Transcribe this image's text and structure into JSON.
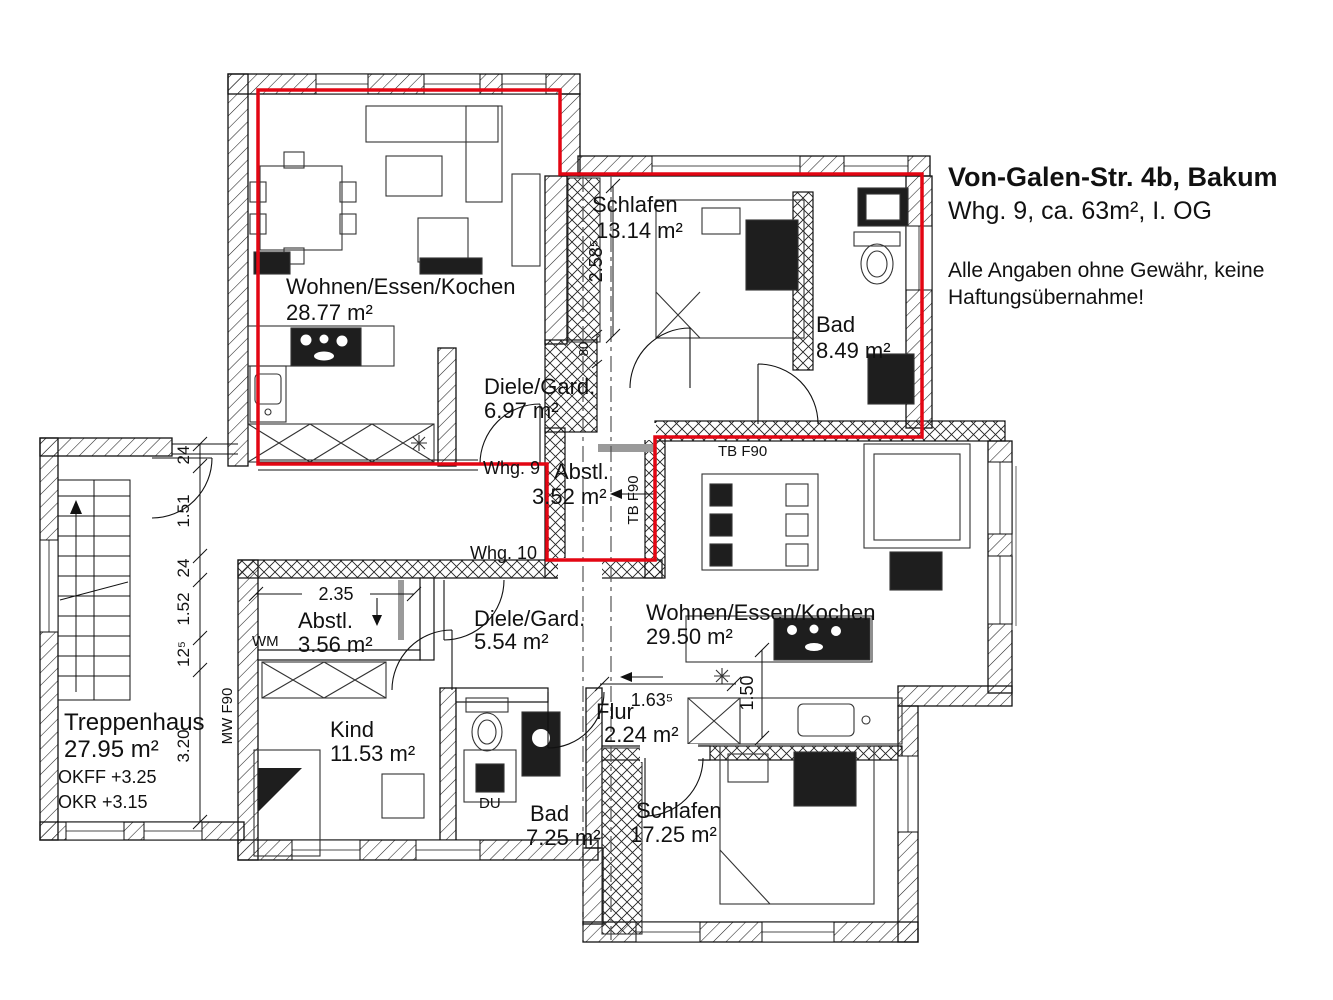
{
  "title": {
    "address": "Von-Galen-Str. 4b, Bakum",
    "unit_info": "Whg. 9, ca. 63m², I. OG",
    "disclaimer_line1": "Alle Angaben ohne Gewähr, keine",
    "disclaimer_line2": "Haftungsübernahme!"
  },
  "unit_labels": {
    "whg9": "Whg. 9",
    "whg10": "Whg. 10"
  },
  "rooms": {
    "living9": {
      "name": "Wohnen/Essen/Kochen",
      "area": "28.77 m²"
    },
    "schlafen9": {
      "name": "Schlafen",
      "area": "13.14 m²"
    },
    "bad9": {
      "name": "Bad",
      "area": "8.49 m²"
    },
    "diele9": {
      "name": "Diele/Gard.",
      "area": "6.97 m²"
    },
    "abstell9": {
      "name": "Abstl.",
      "area": "3.52 m²"
    },
    "treppenhaus": {
      "name": "Treppenhaus",
      "area": "27.95 m²",
      "okff": "OKFF +3.25",
      "okr": "OKR +3.15"
    },
    "abstell10": {
      "name": "Abstl.",
      "area": "3.56 m²"
    },
    "diele10": {
      "name": "Diele/Gard.",
      "area": "5.54 m²"
    },
    "living10": {
      "name": "Wohnen/Essen/Kochen",
      "area": "29.50 m²"
    },
    "kind": {
      "name": "Kind",
      "area": "11.53 m²"
    },
    "flur": {
      "name": "Flur",
      "area": "2.24 m²"
    },
    "bad10": {
      "name": "Bad",
      "area": "7.25 m²"
    },
    "schlafen10": {
      "name": "Schlafen",
      "area": "17.25 m²"
    }
  },
  "dimensions": {
    "chain": [
      "24",
      "1.51",
      "24",
      "1.52",
      "12⁵",
      "3.20"
    ],
    "schlafen9_depth": "2.58⁵",
    "abstell10_width": "2.35",
    "flur_width": "1.63⁵",
    "kitchen10_depth": "1.50",
    "shaft_width": "80"
  },
  "annotations": {
    "wm": "WM",
    "du": "DU",
    "tb_f90_top": "TB F90",
    "tb_f90_side": "TB F90",
    "mw_f90": "MW F90"
  },
  "colors": {
    "outline_red": "#e30613",
    "wall_ink": "#111111"
  }
}
